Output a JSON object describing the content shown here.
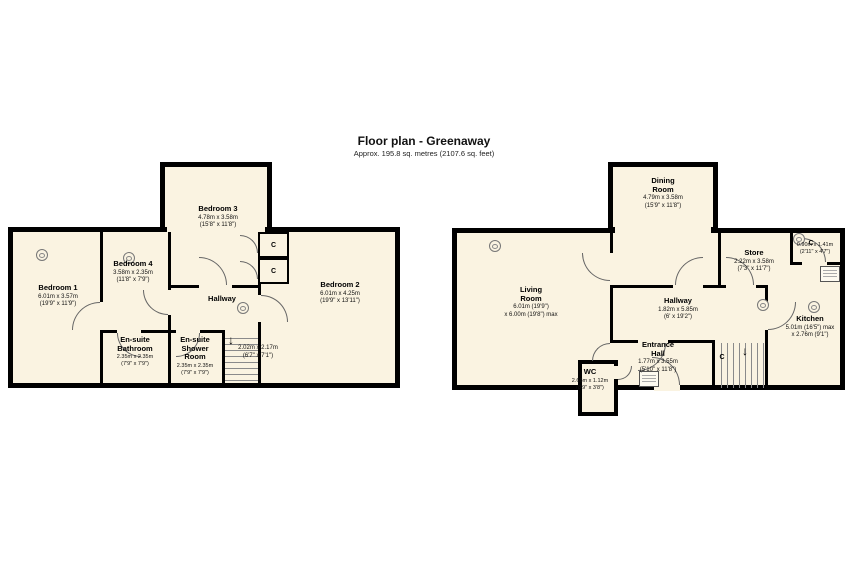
{
  "header": {
    "title": "Floor plan - Greenaway",
    "subtitle": "Approx. 195.8 sq. metres (2107.6 sq. feet)"
  },
  "colors": {
    "floor_fill": "#faf3e1",
    "wall": "#000000"
  },
  "icons": {
    "down_arrow": "↓",
    "light_circle": "light-fixture-icon"
  },
  "left": {
    "bedroom1": {
      "name": "Bedroom 1",
      "dims": "6.01m x 3.57m\n(19'9\" x 11'9\")"
    },
    "bedroom4": {
      "name": "Bedroom 4",
      "dims": "3.58m x 2.35m\n(11'8\" x 7'9\")"
    },
    "bedroom3": {
      "name": "Bedroom 3",
      "dims": "4.78m x 3.58m\n(15'8\" x 11'8\")"
    },
    "bedroom2": {
      "name": "Bedroom 2",
      "dims": "6.01m x 4.25m\n(19'9\" x 13'11\")"
    },
    "hallway": {
      "name": "Hallway"
    },
    "ensuite_bathroom": {
      "name": "En-suite\nBathroom",
      "dims": "2.35m x 2.35m\n(7'9\" x 7'9\")"
    },
    "ensuite_shower": {
      "name": "En-suite\nShower\nRoom",
      "dims": "2.35m x 2.35m\n(7'9\" x 7'9\")"
    },
    "stairs": {
      "dims": "2.02m x 2.17m\n(6'7\" x 7'1\")"
    },
    "closet1": "C",
    "closet2": "C"
  },
  "right": {
    "living": {
      "name": "Living\nRoom",
      "dims": "6.01m (19'9\")\nx 6.00m (19'8\") max"
    },
    "dining": {
      "name": "Dining\nRoom",
      "dims": "4.79m x 3.58m\n(15'9\" x 11'8\")"
    },
    "store": {
      "name": "Store",
      "dims": "2.22m x 3.58m\n(7'3\" x 11'7\")"
    },
    "closet_top": {
      "label": "C",
      "dims": "0.90m x 1.41m\n(2'11\" x 4'7\")"
    },
    "kitchen": {
      "name": "Kitchen",
      "dims": "5.01m (16'5\") max\nx 2.76m (9'1\")"
    },
    "hallway": {
      "name": "Hallway",
      "dims": "1.82m x 5.85m\n(6' x 19'2\")"
    },
    "entrance": {
      "name": "Entrance\nHall",
      "dims": "1.77m x 3.55m\n(5'10\" x 11'8\")"
    },
    "wc": {
      "name": "WC",
      "dims": "2.66m x 1.12m\n(8'9\" x 3'8\")"
    },
    "closet_stairs": "C"
  }
}
